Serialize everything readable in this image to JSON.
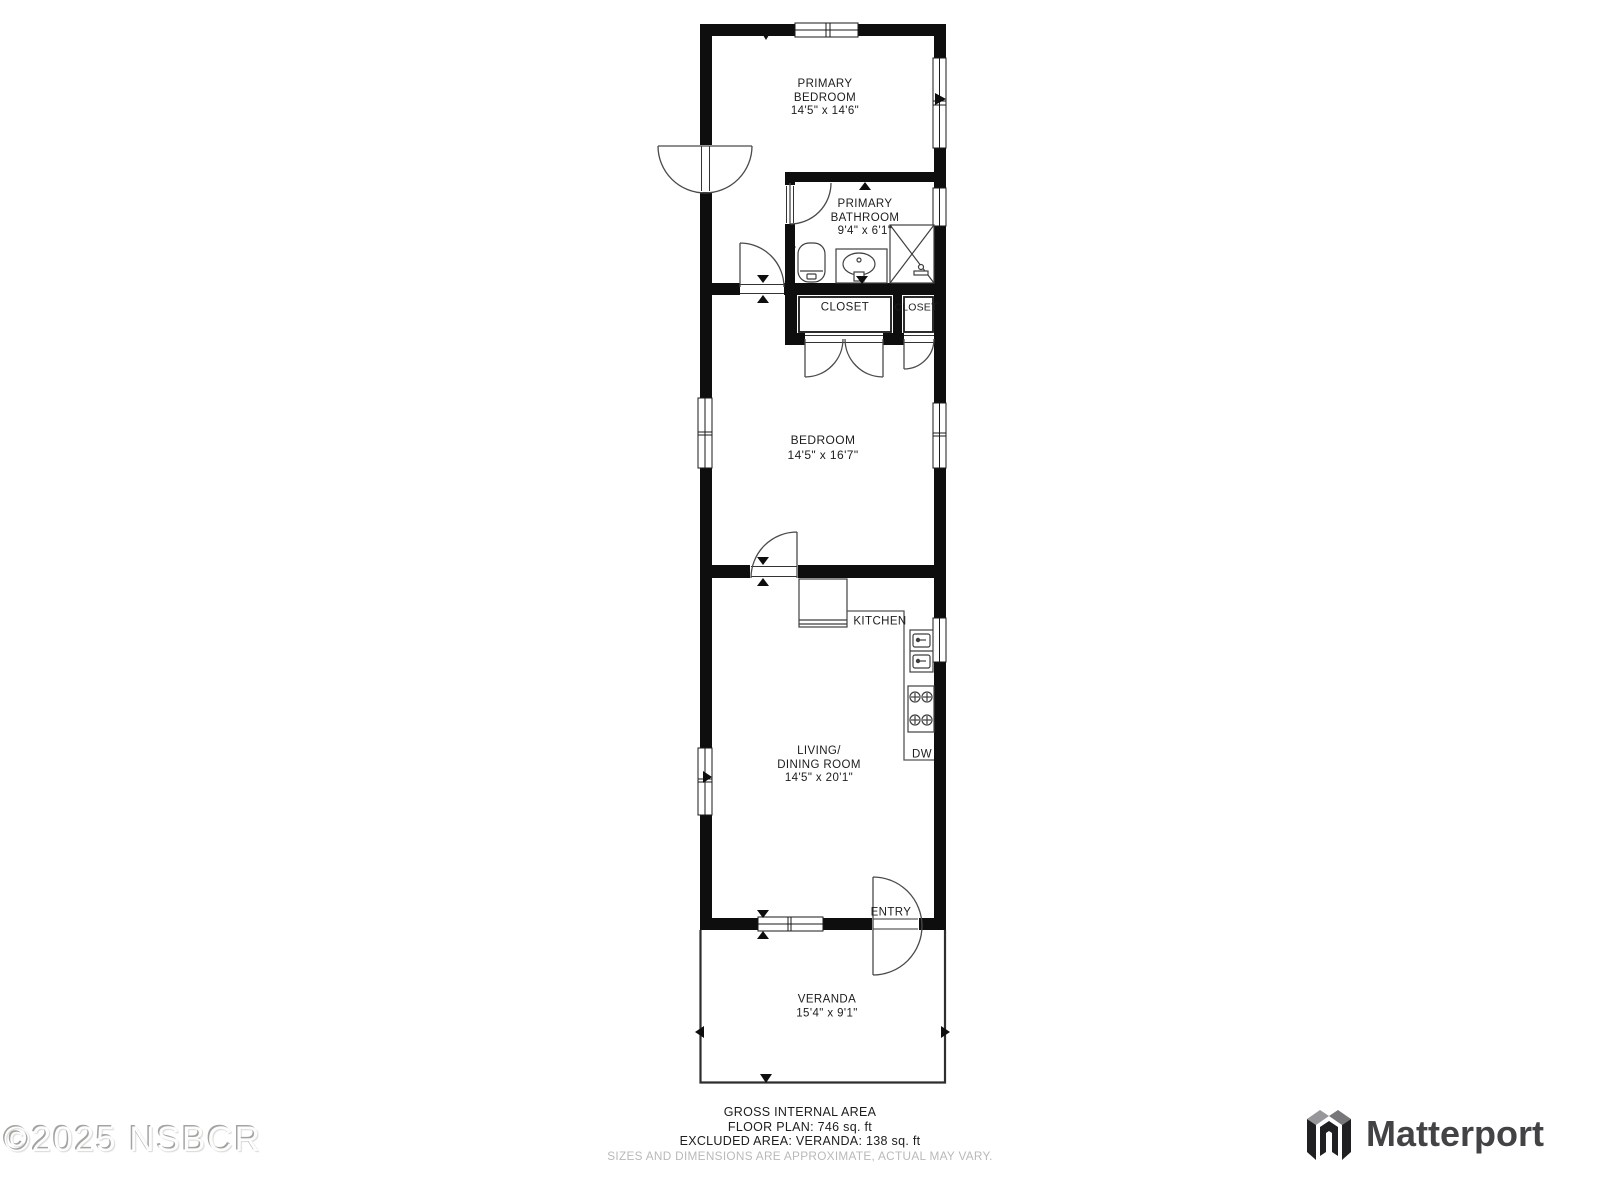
{
  "rooms": {
    "primary_bedroom": [
      "PRIMARY",
      "BEDROOM",
      "14'5\" x 14'6\""
    ],
    "primary_bathroom": [
      "PRIMARY",
      "BATHROOM",
      "9'4\" x 6'1\""
    ],
    "closet_left": "CLOSET",
    "closet_right": "CLOSET",
    "bedroom": [
      "BEDROOM",
      "14'5\" x 16'7\""
    ],
    "kitchen": "KITCHEN",
    "dishwasher": "DW",
    "living_dining": [
      "LIVING/",
      "DINING ROOM",
      "14'5\" x 20'1\""
    ],
    "entry": "ENTRY",
    "veranda": [
      "VERANDA",
      "15'4\" x 9'1\""
    ]
  },
  "footer": {
    "line1": "GROSS INTERNAL AREA",
    "line2": "FLOOR PLAN: 746 sq. ft",
    "line3": "EXCLUDED AREA: VERANDA: 138 sq. ft",
    "line4": "SIZES AND DIMENSIONS ARE APPROXIMATE, ACTUAL MAY VARY."
  },
  "watermark": {
    "text": "©2025 NSBCR"
  },
  "brand": {
    "name": "Matterport"
  },
  "colors": {
    "wall": "#0e0e0e",
    "label_text": "#1d1d1d",
    "muted_text": "#b9b9b9",
    "brand_text": "#434346",
    "background": "#ffffff"
  }
}
